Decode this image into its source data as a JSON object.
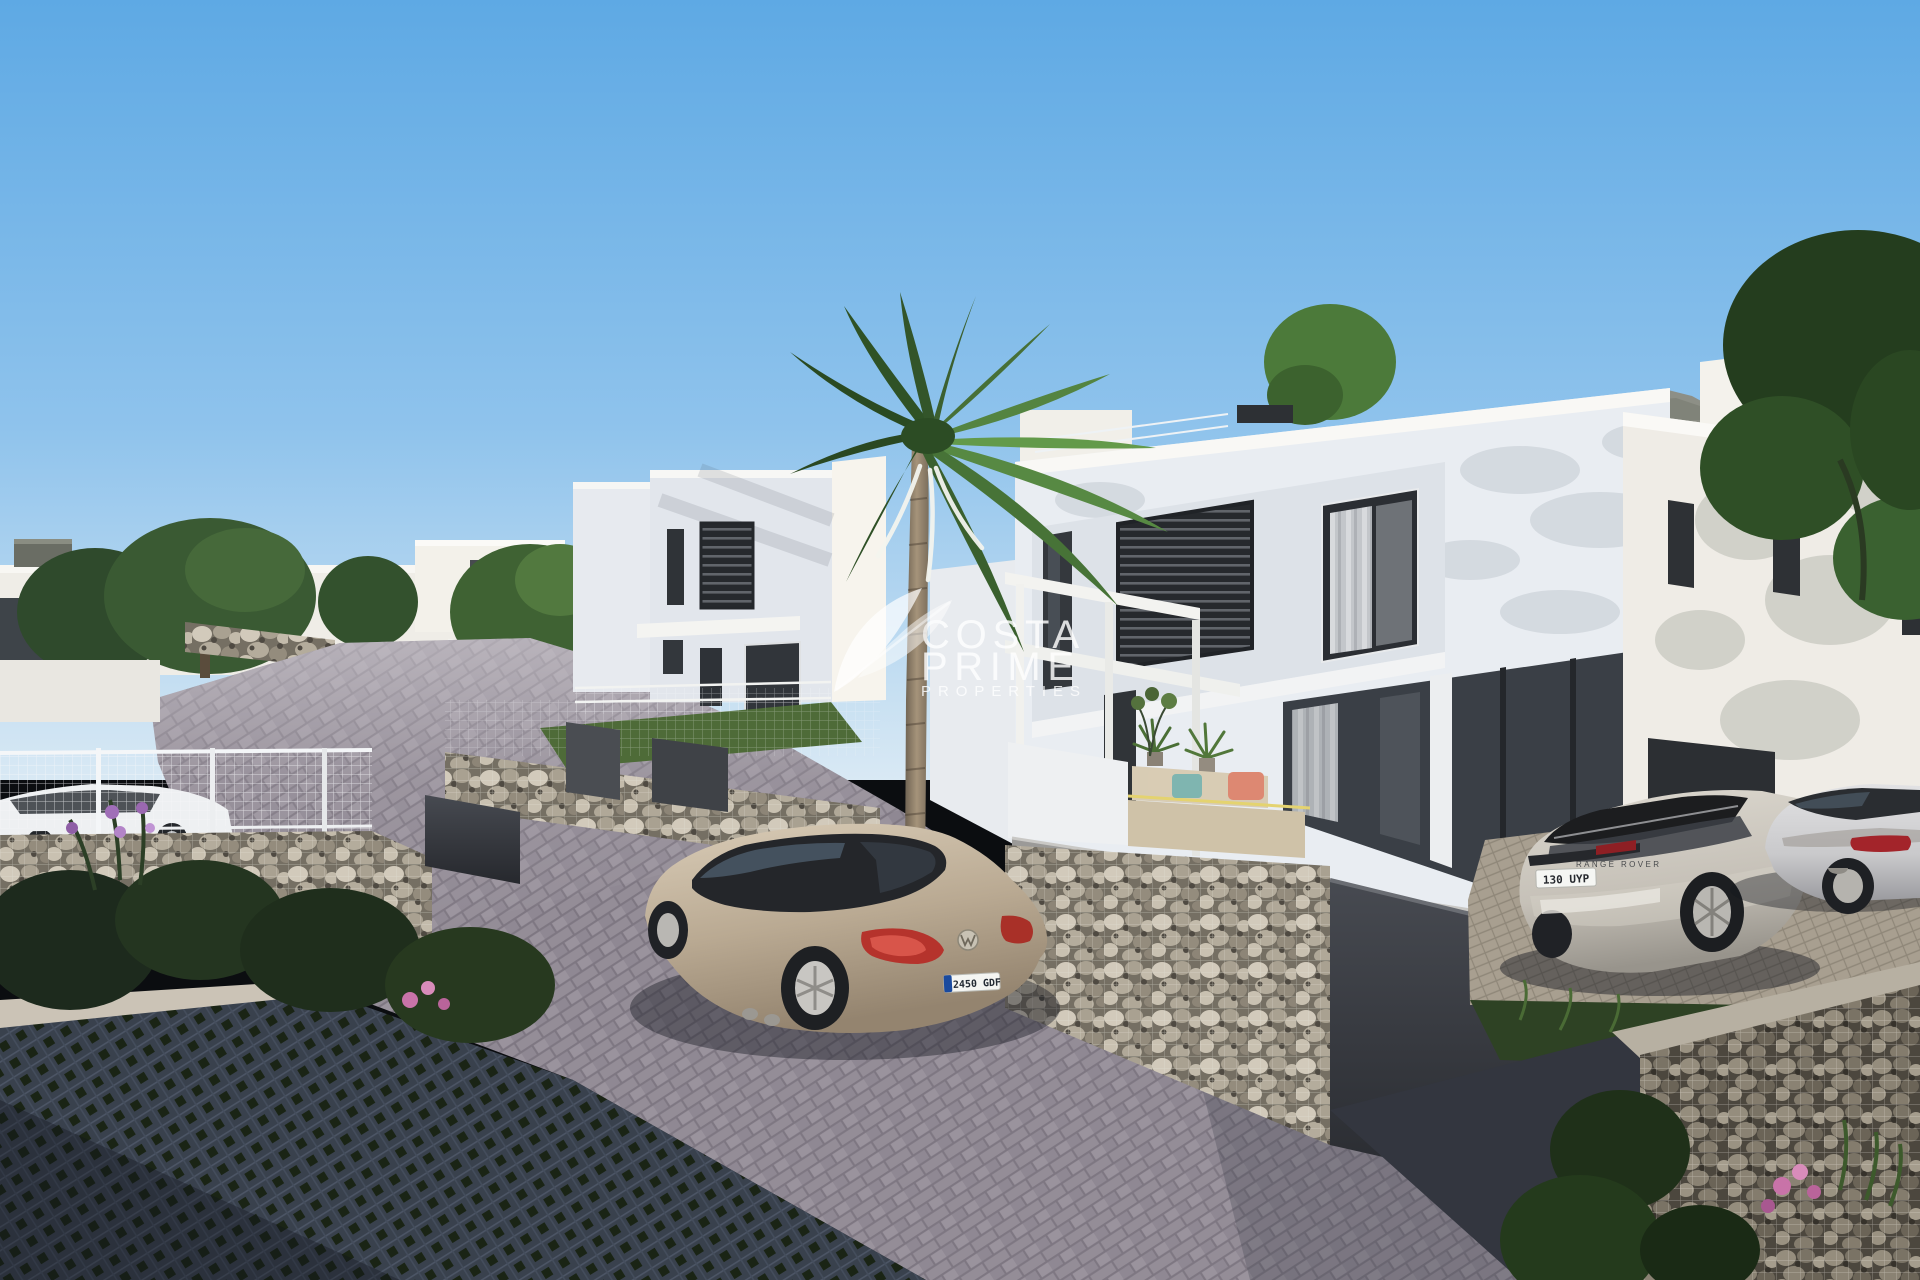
{
  "scene": {
    "type": "3d-architectural-rendering",
    "subject": "New-build development of modern white villas on a sloped paved street with a palm tree, gabion stone walls and parked cars"
  },
  "watermark": {
    "line1": "COSTA",
    "line2": "PRIME",
    "line3": "PROPERTIES",
    "color": "#ffffff"
  },
  "vehicles": {
    "sedan": {
      "brand_icon": "vw-logo",
      "license_plate": "2450 GDF",
      "body_color": "#b9a992"
    },
    "suv": {
      "tailgate_badge": "RANGE ROVER",
      "license_plate": "130 UYP",
      "body_color": "#c6c1b8"
    },
    "coupe": {
      "body_color": "#c9c9cb"
    },
    "parked_white_car": {
      "body_color": "#eef0f2"
    }
  },
  "palette": {
    "sky_top": "#5ea9e4",
    "sky_mid": "#8fc3ec",
    "sky_horizon": "#d9e9f4",
    "wall_sunlit": "#f6f3ed",
    "wall_shaded": "#e3e7ed",
    "window_dark": "#2b2e33",
    "road_sunlit": "#948d97",
    "road_shadow": "#3a3f4e",
    "gabion_stone": "#b9b1a1",
    "foliage_dark": "#2c4626",
    "foliage_light": "#5d8f45",
    "plate_blue": "#1a4a9e",
    "taillight_red": "#b5332c"
  }
}
